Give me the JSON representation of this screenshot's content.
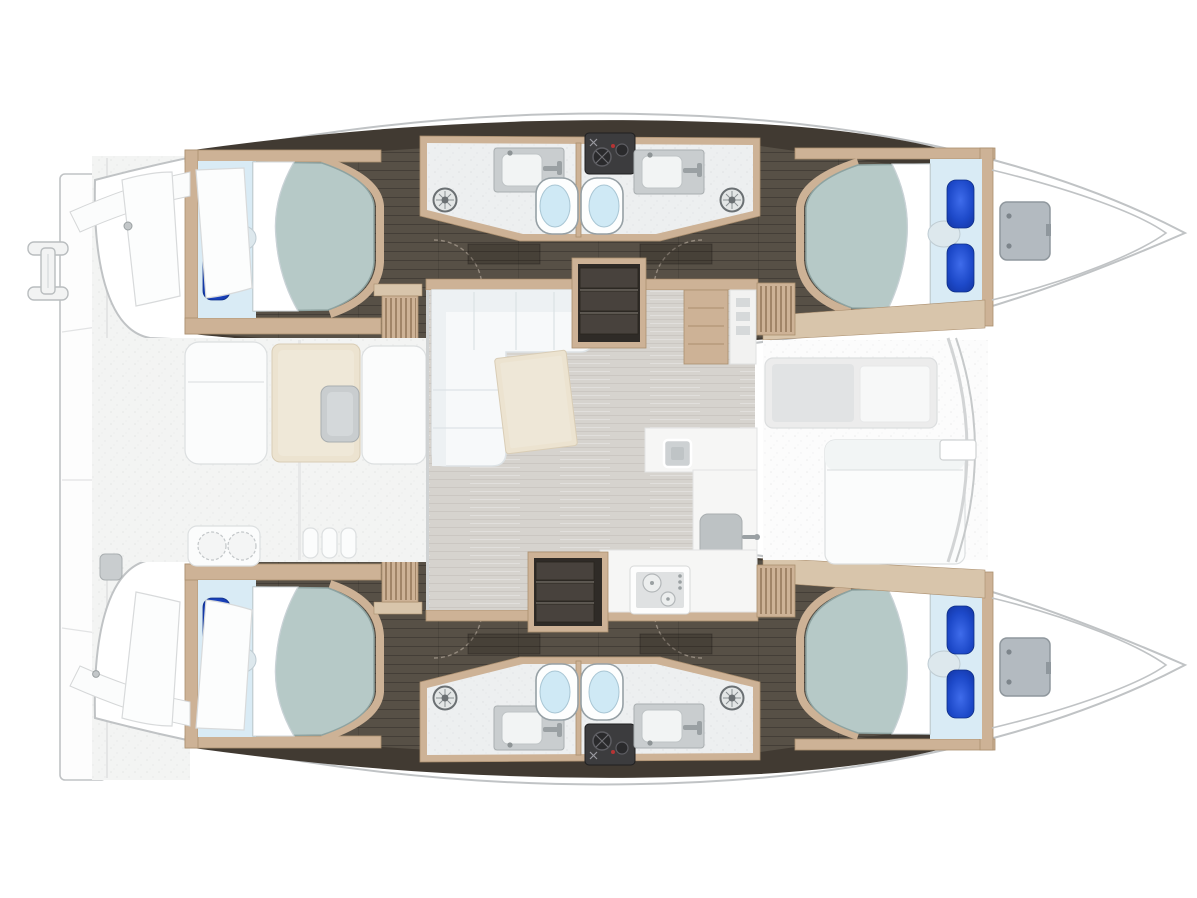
{
  "title": "Catamaran yacht floor plan — top-down view, 4 cabins / 4 heads",
  "colors": {
    "outline": "#c0c3c5",
    "hull_white": "#ffffff",
    "deck": "#f3f4f3",
    "deck_line": "#e2e3e4",
    "hull_floor": "#575046",
    "hull_floor_dark": "#413a32",
    "wood": "#cdb296",
    "wood_dark": "#ab8f6f",
    "wood_walkway": "#d8c5ab",
    "mattress": "#b6c9c7",
    "mattress_edge": "#8ea3a1",
    "linen": "#d9ebf5",
    "sheet": "#ffffff",
    "pillow": "#1d49c9",
    "pillow_dark": "#10309b",
    "bolster": "#dde8ed",
    "bath_floor": "#edeff0",
    "counter_gray": "#c9cdcf",
    "basin": "#f2f4f4",
    "toilet_inner": "#cfe9f5",
    "tech": "#3c3c3e",
    "salon_floor": "#d6d3ce",
    "sofa": "#f7f9fa",
    "sofa_line": "#dde3e6",
    "table": "#ece3d0",
    "steps": "#48423d",
    "hatch": "#b3bac0"
  },
  "vessel": {
    "type": "sailing catamaran",
    "view": "top-down interior floor plan",
    "bow_direction": "right",
    "stern_direction": "left",
    "cabins": 4,
    "heads": 4,
    "berths": "4 double berths with 2 blue pillows and bolster each"
  },
  "areas": {
    "port_hull_top": {
      "label": "Port hull (top)",
      "rooms": [
        "aft double cabin",
        "aft head with shower, sink, toilet",
        "forward head with toilet, sink, shower",
        "forward double cabin",
        "bow anchor locker with deck hatch"
      ]
    },
    "starboard_hull_bottom": {
      "label": "Starboard hull (bottom, mirrored)",
      "rooms": [
        "aft double cabin",
        "aft head",
        "forward head",
        "forward double cabin",
        "bow locker"
      ]
    },
    "salon": {
      "label": "Bridge-deck salon",
      "furniture": [
        "L-shaped sofa",
        "coffee table",
        "nav station",
        "L-shaped galley counter",
        "square galley sink",
        "main sink with faucet",
        "two-burner gas stove",
        "companionway steps to each hull",
        "louvered vent lockers"
      ]
    },
    "aft_cockpit": {
      "label": "Aft cockpit (left)",
      "furniture": [
        "helm consoles",
        "bench",
        "cockpit table",
        "bench",
        "grill module",
        "step fins",
        "transom platform",
        "swim ladder",
        "deck hatches"
      ]
    },
    "forward_cockpit": {
      "label": "Forward cockpit (right)",
      "furniture": [
        "recessed seat",
        "sun bench",
        "crossbeam arch"
      ]
    }
  }
}
